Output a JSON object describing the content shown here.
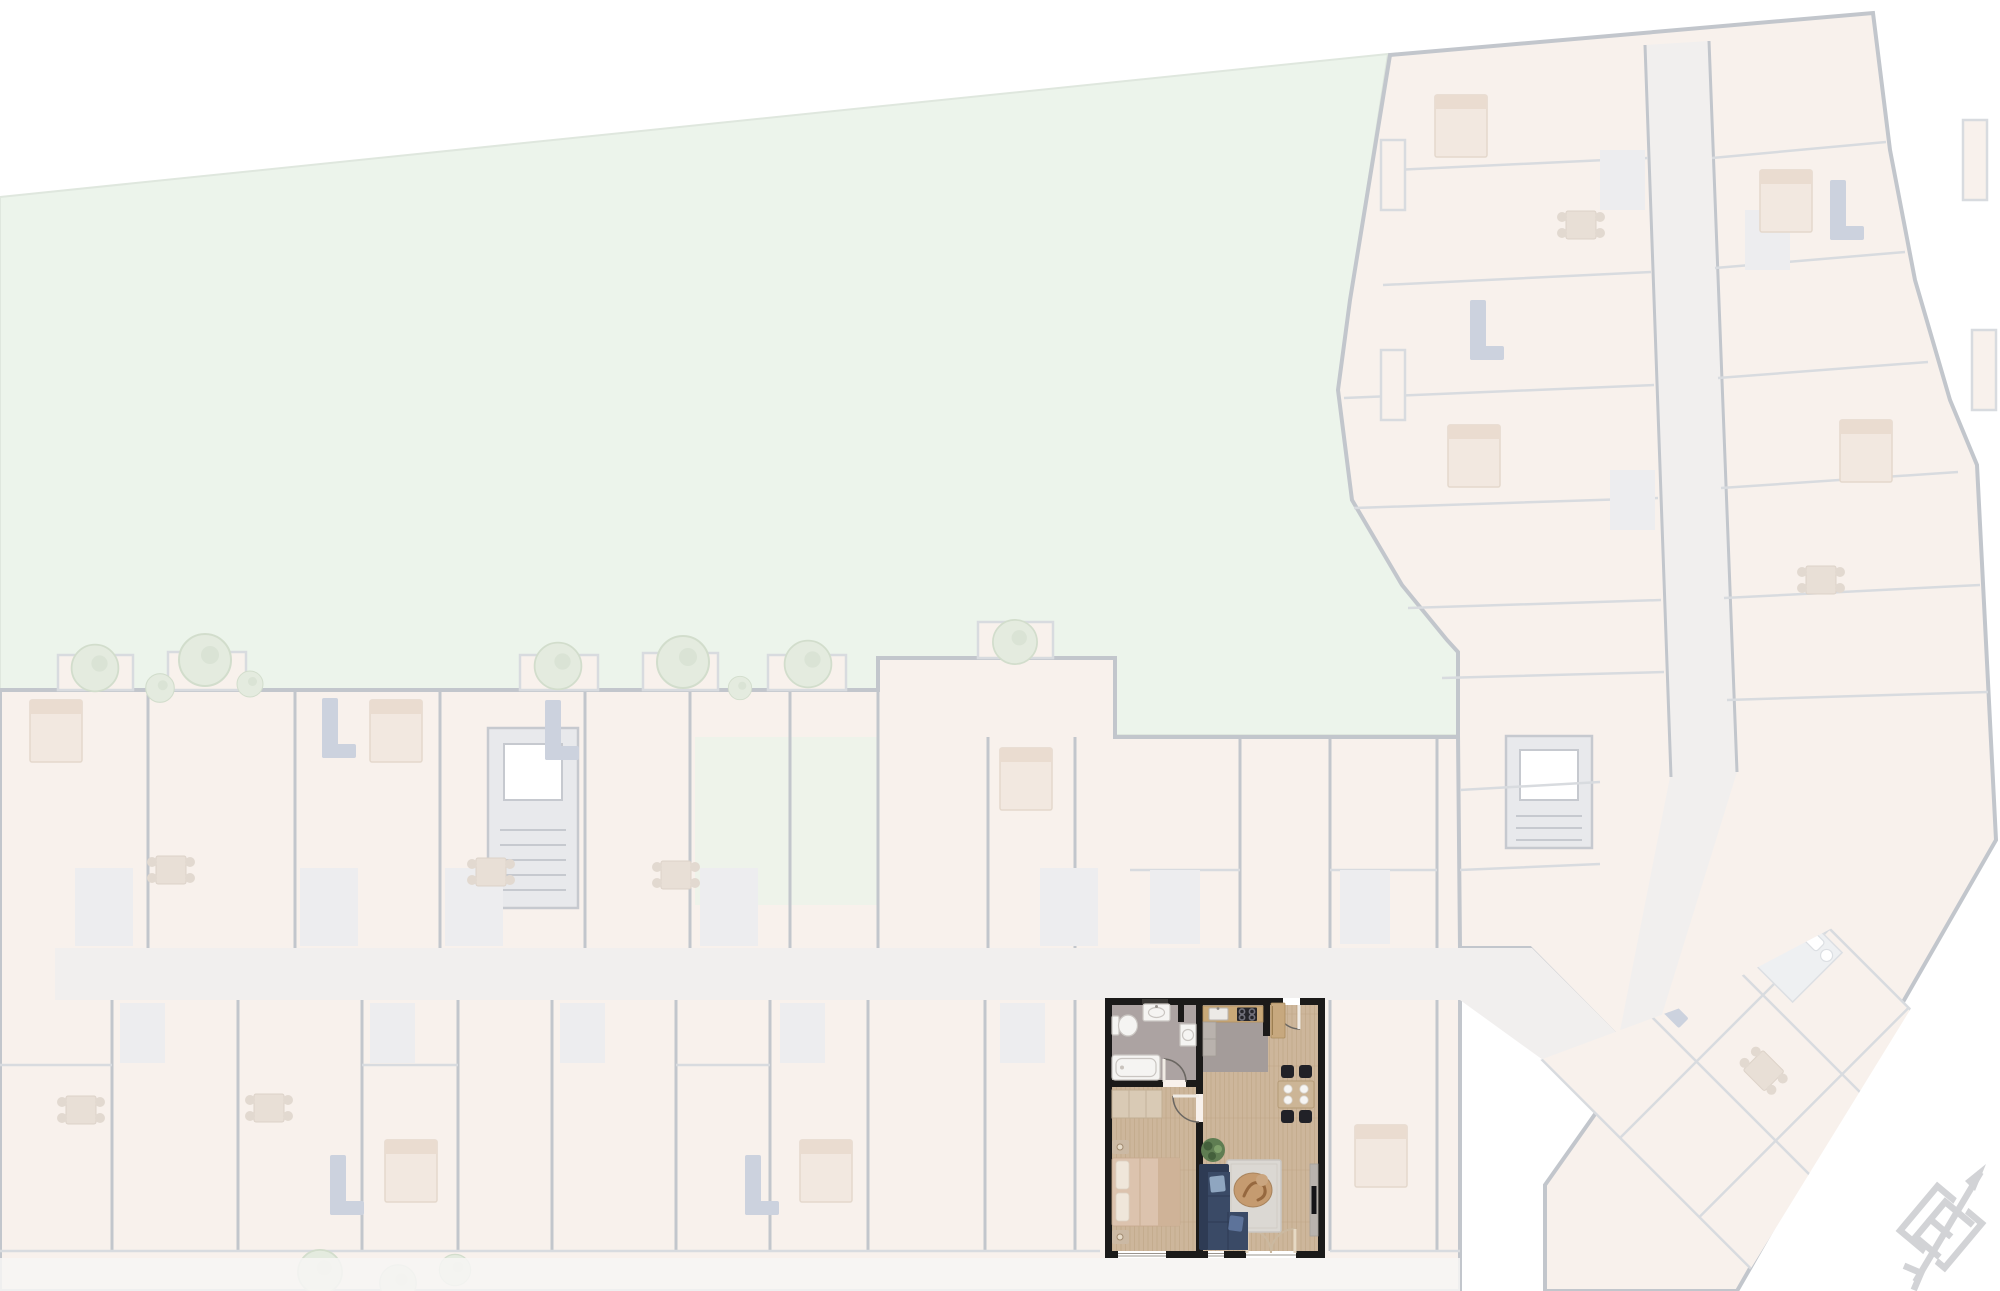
{
  "canvas": {
    "width": 2000,
    "height": 1291
  },
  "colors": {
    "bg": "#ffffff",
    "garden": "#ecf4eb",
    "gardenEdge": "#dfe7de",
    "courtyard": "#eef3ea",
    "fadedRoom": "#f8f1ec",
    "fadedRoomCool": "#ededef",
    "fadedWall": "#c2c6cc",
    "fadedWallLight": "#d8dbdf",
    "corridor": "#f1efee",
    "shaftFill": "#e8e9ec",
    "shaftBorder": "#c6c9cf",
    "treeFill": "#e4ebdf",
    "treeStroke": "#d2ddcc",
    "furnNavy": "#ccd2de",
    "terrace": "#f7f6f4",
    "compass": "#d2d3d6",
    "apt": {
      "wall": "#1b1a19",
      "wood": "#cdb69b",
      "woodGrain": "#b89f7e",
      "bathFloor": "#aca3a2",
      "kitchenFloor": "#a49c9a",
      "fixture": "#f5f4f2",
      "fixtureEdge": "#c9c5c1",
      "counter": "#c8a878",
      "cooktop": "#26262b",
      "cabinet": "#b9b2ad",
      "fridgeWood": "#c7a87e",
      "wardrobe": "#d9cab5",
      "wardrobeLine": "#c4b29a",
      "bed": "#dcc3ae",
      "pillow": "#efe6da",
      "throw": "#cdb196",
      "sideTable": "#cbb9a4",
      "sofa": "#3a4a66",
      "sofaDark": "#2e3b54",
      "cushion": "#8fa6c0",
      "rug": "#dbd8d3",
      "rugEdge": "#c9c6c1",
      "pet": "#c59b70",
      "petDark": "#96683f",
      "chair": "#212127",
      "table": "#ccb596",
      "plate": "#f6f5f3",
      "plant": "#5f7d52",
      "plantDark": "#44603c",
      "tv": "#141418",
      "lowboard": "#b9b3ae",
      "doorLeaf": "#f0ebe4",
      "arcLine": "#6b6762",
      "frenchArc": "#cbb9a0",
      "frenchLeaf": "#e6d9c4"
    }
  },
  "garden": {
    "name": "garden-lawn"
  },
  "buildings": {
    "west_block": "faded-apartment-block",
    "east_wing": "faded-apartment-wing",
    "southeast_wedge": "faded-apartment-wedge-rotated-45"
  },
  "apartment": {
    "name": "highlighted-apartment",
    "rooms": [
      "bathroom",
      "bedroom",
      "kitchen",
      "living-dining"
    ],
    "furniture": [
      "bathtub",
      "toilet",
      "bathroom-sink",
      "washing-machine",
      "mirror",
      "wardrobe",
      "double-bed",
      "nightstands",
      "kitchen-counter",
      "kitchen-sink",
      "cooktop",
      "tall-cabinet",
      "fridge",
      "dining-table",
      "dining-chairs",
      "plates",
      "corner-sofa",
      "cushions",
      "rug",
      "pet-on-rug",
      "floor-plant",
      "tv-lowboard",
      "tv",
      "entry-door",
      "bathroom-door",
      "bedroom-door",
      "french-balcony-doors",
      "windows"
    ]
  },
  "compass": {
    "name": "north-arrow-logo"
  }
}
